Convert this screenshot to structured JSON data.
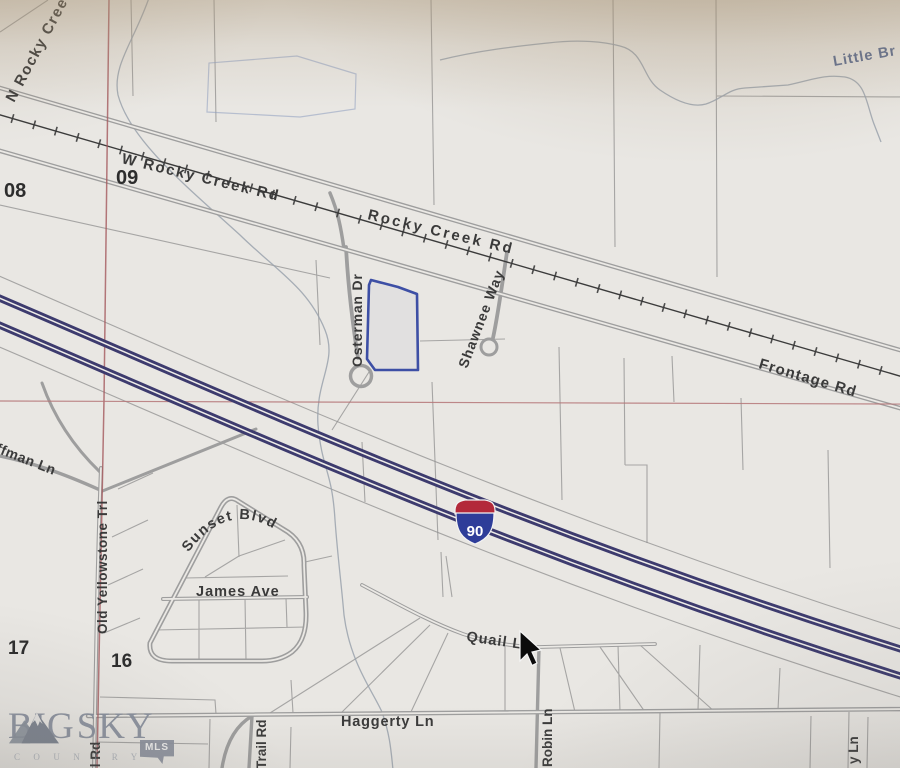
{
  "map": {
    "sections": {
      "s08": "08",
      "s09": "09",
      "s16": "16",
      "s17": "17"
    },
    "shield": {
      "route": "90"
    },
    "streets": {
      "n_rocky_creek": "N Rocky Cree",
      "w_rocky_creek_rd": "W Rocky Creek Rd",
      "rocky_creek_rd": "Rocky Creek Rd",
      "osterman_dr": "Osterman Dr",
      "shawnee_way": "Shawnee Way",
      "frontage_rd": "Frontage Rd",
      "huffman_ln": "ffman Ln",
      "old_yellowstone_trl": "Old Yellowstone Trl",
      "sunset_blvd": "Sunset Blvd",
      "james_ave": "James Ave",
      "quail_ln": "Quail Ln",
      "haggerty_ln": "Haggerty Ln",
      "trail_rd": "Trail Rd",
      "robin_ln": "Robin Ln",
      "il_rd": "il Rd",
      "y_ln": "y Ln"
    },
    "water": {
      "little_br": "Little Br"
    }
  },
  "branding": {
    "big": "BIG",
    "sky": "SKY",
    "country": "C O U N T R Y",
    "mls": "MLS"
  },
  "icons": {
    "cursor": "arrow-pointer",
    "mountain": "mountain-logo"
  },
  "colors": {
    "interstate": "#3d3b6e",
    "highlight_parcel": "#3d4fa5",
    "section_line": "#a4595c",
    "shield_red": "#b3293a",
    "shield_blue": "#2e3d99",
    "water_label": "#5d6d91",
    "road": "#9e9e9e"
  }
}
